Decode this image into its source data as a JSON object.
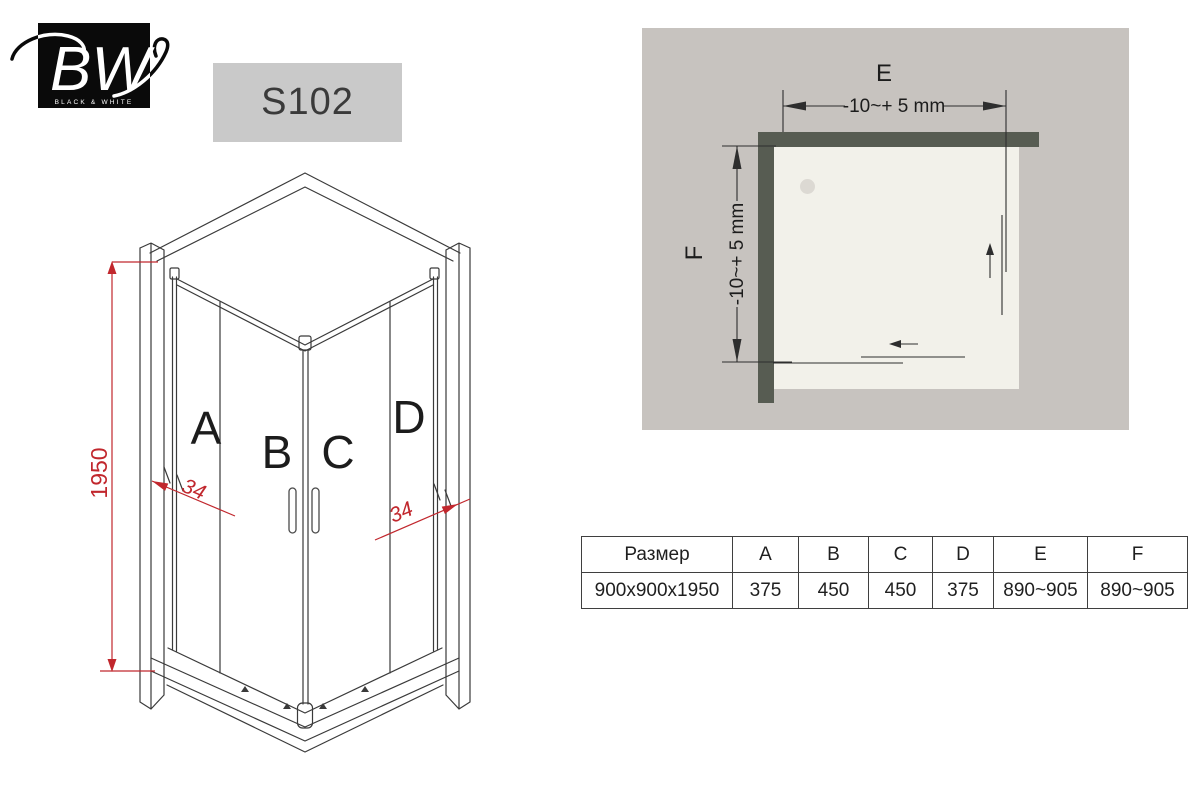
{
  "logo": {
    "brand_initials": "BW",
    "brand_name": "BLACK & WHITE"
  },
  "product": {
    "model": "S102"
  },
  "iso_drawing": {
    "panel_labels": {
      "a": "A",
      "b": "B",
      "c": "C",
      "d": "D"
    },
    "height_dim": "1950",
    "profile_dim_left": "34",
    "profile_dim_right": "34",
    "line_color": "#3a3a3a",
    "dim_color": "#c1272d"
  },
  "plan_view": {
    "width_label": "E",
    "width_tolerance": "-10~+ 5 mm",
    "depth_label": "F",
    "depth_tolerance": "-10~+ 5 mm",
    "colors": {
      "background": "#c7c3bf",
      "wall": "#575c52",
      "floor": "#f2f1ea"
    }
  },
  "size_table": {
    "headers": [
      "Размер",
      "A",
      "B",
      "C",
      "D",
      "E",
      "F"
    ],
    "row": [
      "900x900x1950",
      "375",
      "450",
      "450",
      "375",
      "890~905",
      "890~905"
    ]
  }
}
